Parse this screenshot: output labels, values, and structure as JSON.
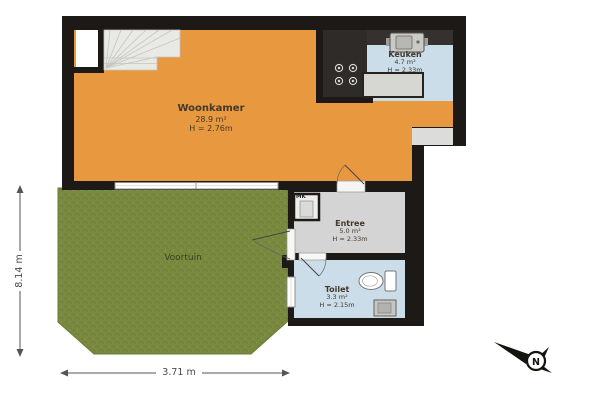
{
  "rooms": {
    "woonkamer": {
      "name": "Woonkamer",
      "area": "28.9 m²",
      "height": "H = 2.76m"
    },
    "keuken": {
      "name": "Keuken",
      "area": "4.7 m²",
      "height": "H = 2.33m"
    },
    "entree": {
      "name": "Entree",
      "area": "5.0 m²",
      "height": "H = 2.33m"
    },
    "toilet": {
      "name": "Toilet",
      "area": "3.3 m²",
      "height": "H = 2.15m"
    },
    "voortuin": {
      "name": "Voortuin"
    }
  },
  "labels": {
    "meter_closet": "MK"
  },
  "dimensions": {
    "bottom_width": "3.71 m",
    "left_height": "8.14 m"
  },
  "compass": {
    "north_label": "N"
  },
  "colors": {
    "living_room_floor": "#E8993F",
    "wet_room_floor": "#CBDDE9",
    "hall_floor": "#D4D4D4",
    "garden": "#79893F",
    "wall": "#1C1917"
  }
}
